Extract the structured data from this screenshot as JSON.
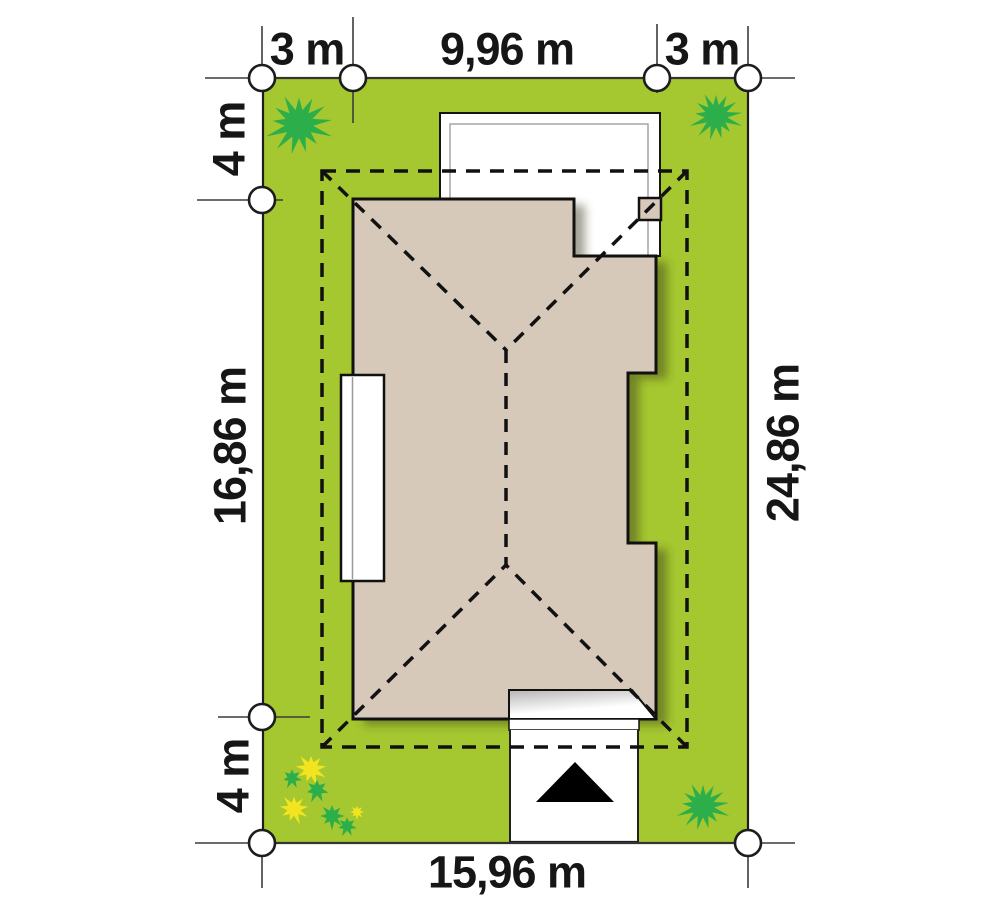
{
  "plan": {
    "type": "site-plan",
    "dimensions": {
      "top": [
        {
          "id": "left-side-setback",
          "label": "3 m"
        },
        {
          "id": "house-width",
          "label": "9,96 m"
        },
        {
          "id": "right-side-setback",
          "label": "3 m"
        }
      ],
      "left": [
        {
          "id": "front-setback",
          "label": "4 m"
        },
        {
          "id": "house-depth",
          "label": "16,86 m"
        },
        {
          "id": "rear-setback",
          "label": "4 m"
        }
      ],
      "right": [
        {
          "id": "plot-depth",
          "label": "24,86 m"
        }
      ],
      "bottom": [
        {
          "id": "plot-width",
          "label": "15,96 m"
        }
      ]
    },
    "colors": {
      "lawn": "#a5c730",
      "shrub": "#2cae4b",
      "flower": "#f2e41e",
      "roof": "#d7c9ba",
      "paving": "#ffffff",
      "outline": "#141414"
    }
  }
}
